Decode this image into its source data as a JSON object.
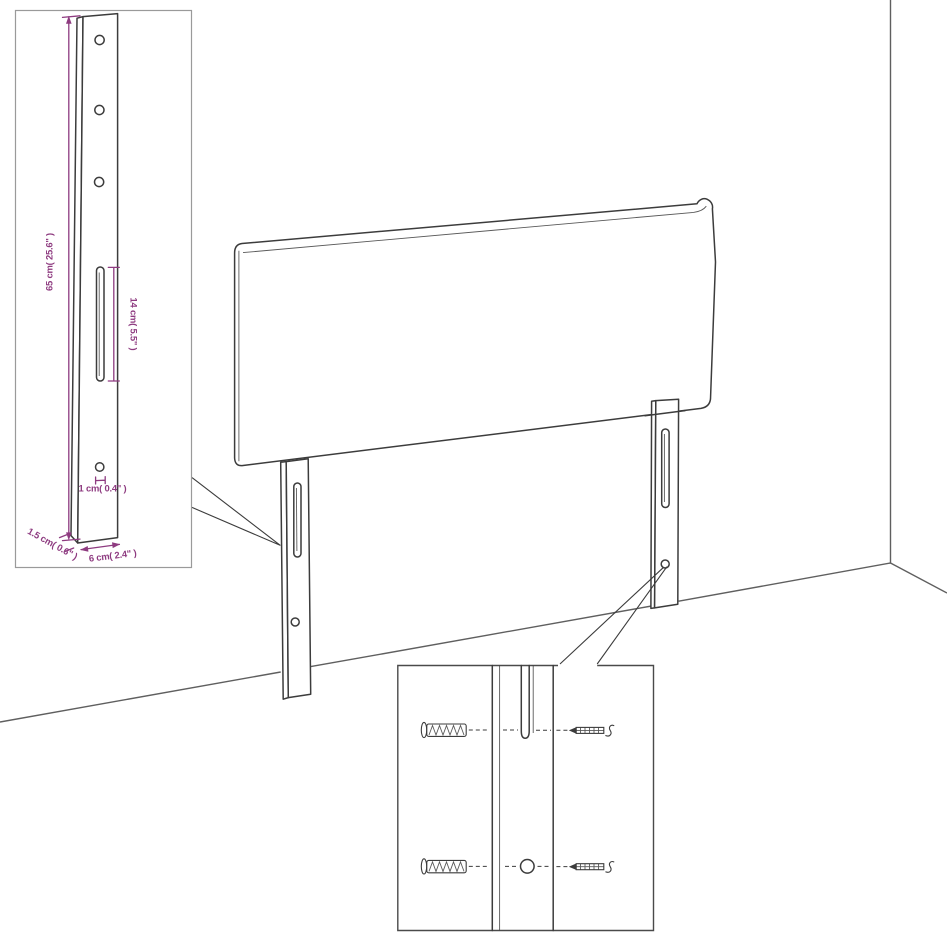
{
  "palette": {
    "background": "#ffffff",
    "line_color": "#3c3c3c",
    "dimension_color": "#8e3b80",
    "room_line_color": "#5f5f5f",
    "inset1_border_color": "#9a9a9a",
    "inset2_border_color": "#4a4a4a"
  },
  "labels": {
    "leg_height": "65 cm( 25.6\" )",
    "slot_length": "14 cm( 5.5\" )",
    "hole_diameter": "1 cm( 0.4\" )",
    "leg_thickness": "1.5 cm( 0.6\" )",
    "leg_width": "6 cm( 2.4\" )"
  }
}
